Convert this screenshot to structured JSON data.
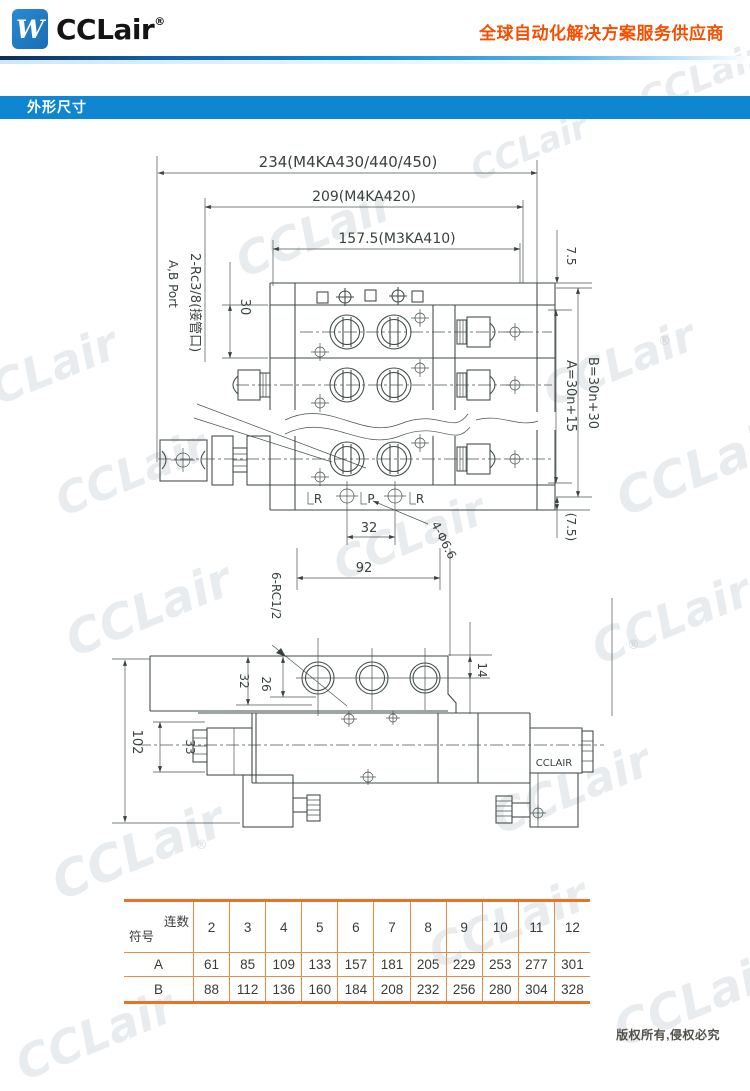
{
  "header": {
    "logo_glyph": "W",
    "brand": "CCLair",
    "registered": "®",
    "slogan": "全球自动化解决方案服务供应商"
  },
  "section_bar": {
    "title": "外形尺寸"
  },
  "drawing": {
    "top_view": {
      "dim_width_overall": "234(M4KA430/440/450)",
      "dim_width_mid": "209(M4KA420)",
      "dim_width_inner": "157.5(M3KA410)",
      "dim_top_offset": "7.5",
      "dim_bottom_offset": "(7.5)",
      "dim_b_formula": "B=30n+30",
      "dim_a_formula": "A=30n+15",
      "dim_station_pitch": "30",
      "dim_port_spacing": "32",
      "dim_mount_spacing": "92",
      "label_side_ports": "2-Rc3/8(接管口)",
      "label_side_ports_en": "A,B Port",
      "label_mount_holes": "4-Φ6.6",
      "port_r_left": "R",
      "port_p": "P",
      "port_r_right": "R"
    },
    "front_view": {
      "label_bottom_ports": "6-RC1/2",
      "dim_32": "32",
      "dim_26": "26",
      "dim_height": "102",
      "dim_33": "33",
      "dim_14": "14",
      "coil_label": "CCLAIR"
    }
  },
  "table": {
    "corner_top": "连数",
    "corner_bottom": "符号",
    "columns": [
      "2",
      "3",
      "4",
      "5",
      "6",
      "7",
      "8",
      "9",
      "10",
      "11",
      "12"
    ],
    "rows": [
      {
        "label": "A",
        "values": [
          "61",
          "85",
          "109",
          "133",
          "157",
          "181",
          "205",
          "229",
          "253",
          "277",
          "301"
        ]
      },
      {
        "label": "B",
        "values": [
          "88",
          "112",
          "136",
          "160",
          "184",
          "208",
          "232",
          "256",
          "280",
          "304",
          "328"
        ]
      }
    ]
  },
  "footer": {
    "copyright": "版权所有,侵权必究"
  },
  "watermark": {
    "text": "CCLair",
    "reg": "®"
  }
}
